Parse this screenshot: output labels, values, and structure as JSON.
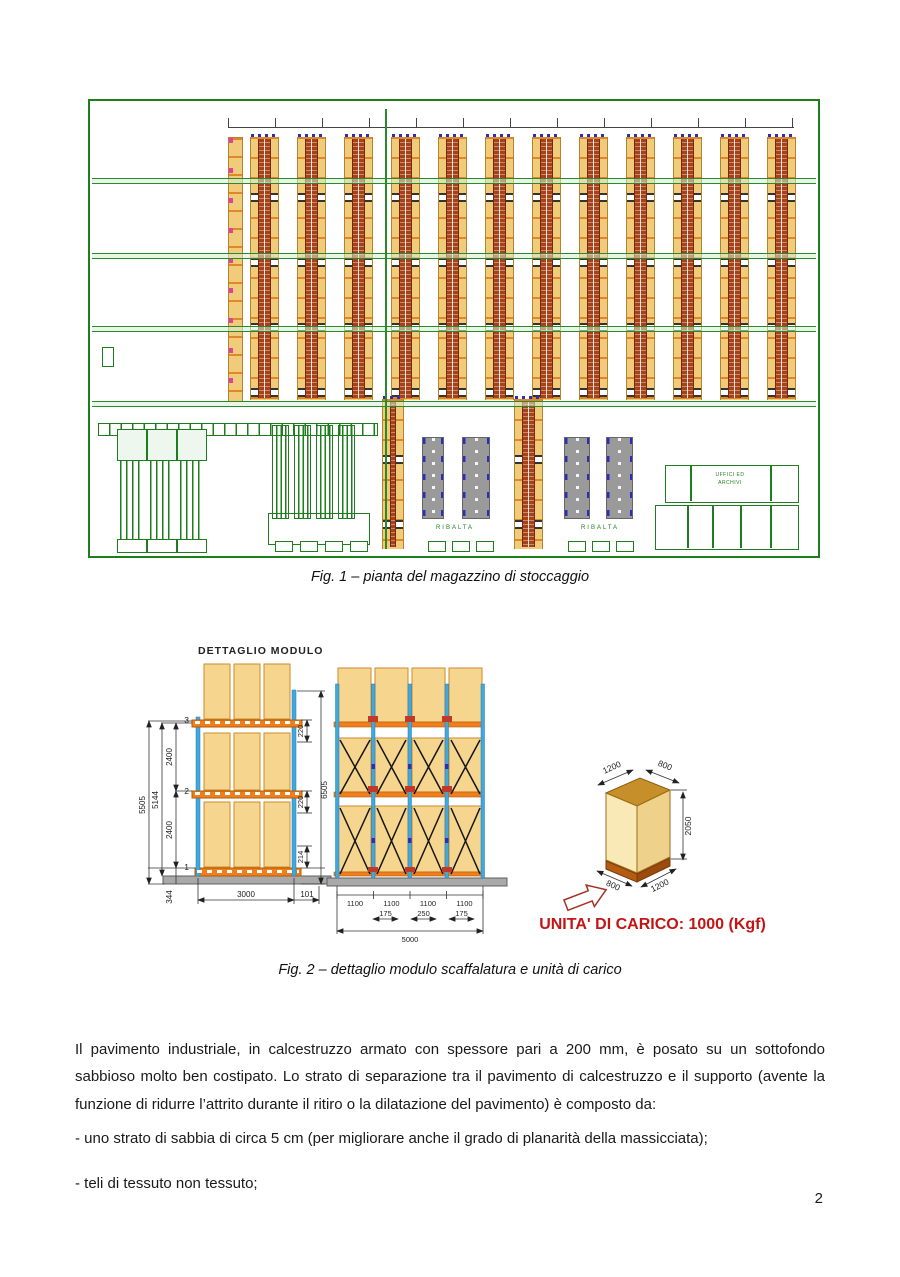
{
  "figure1": {
    "caption": "Fig. 1 – pianta del magazzino di stoccaggio",
    "plan": {
      "dock_labels": [
        "RIBALTA",
        "RIBALTA"
      ],
      "office_label_line1": "UFFICI ED",
      "office_label_line2": "ARCHIVI"
    }
  },
  "figure2": {
    "caption": "Fig. 2 – dettaglio modulo scaffalatura e unità di carico",
    "module_title": "DETTAGLIO MODULO",
    "side_view": {
      "level_top": "3",
      "level_mid": "2",
      "level_bottom": "1",
      "dim_total_height": "5505",
      "dim_inner_height": "5144",
      "dim_level_pitch": "2400",
      "dim_base_height": "344",
      "dim_right_total": "6505",
      "dim_beam_depth": "220",
      "dim_base_beam": "214",
      "dim_bay_width": "3000",
      "dim_side_offset": "101"
    },
    "front_view": {
      "dim_bay": "1100",
      "dim_gap_side": "175",
      "dim_gap_center": "250",
      "dim_total_width": "5000"
    },
    "unit_load": {
      "dim_top_depth": "1200",
      "dim_top_width": "800",
      "dim_height": "2050",
      "dim_bottom_width": "800",
      "dim_bottom_depth": "1200",
      "caption": "UNITA' DI CARICO: 1000 (Kgf)"
    }
  },
  "body": {
    "paragraph1": "Il pavimento industriale, in calcestruzzo armato con spessore pari a 200 mm, è posato su un sottofondo sabbioso molto ben costipato. Lo strato di separazione tra il pavimento di calcestruzzo e il supporto (avente la funzione di ridurre l’attrito durante il ritiro o la dilatazione del pavimento) è composto da:",
    "bullet1": "- uno strato di sabbia di circa 5 cm (per migliorare anche il grado di planarità della massicciata);",
    "bullet2": "- teli di tessuto non tessuto;",
    "page_number": "2"
  },
  "colors": {
    "plan_green": "#1e7e1e",
    "rack_yellow": "#f0cc7a",
    "rack_red": "#a5421c",
    "beam_orange": "#ef7f1d",
    "upright_blue": "#43a7dc",
    "pallet_yellow": "#f6d58f",
    "dock_gray": "#9a9a9a",
    "unit_caption_red": "#c41414"
  }
}
